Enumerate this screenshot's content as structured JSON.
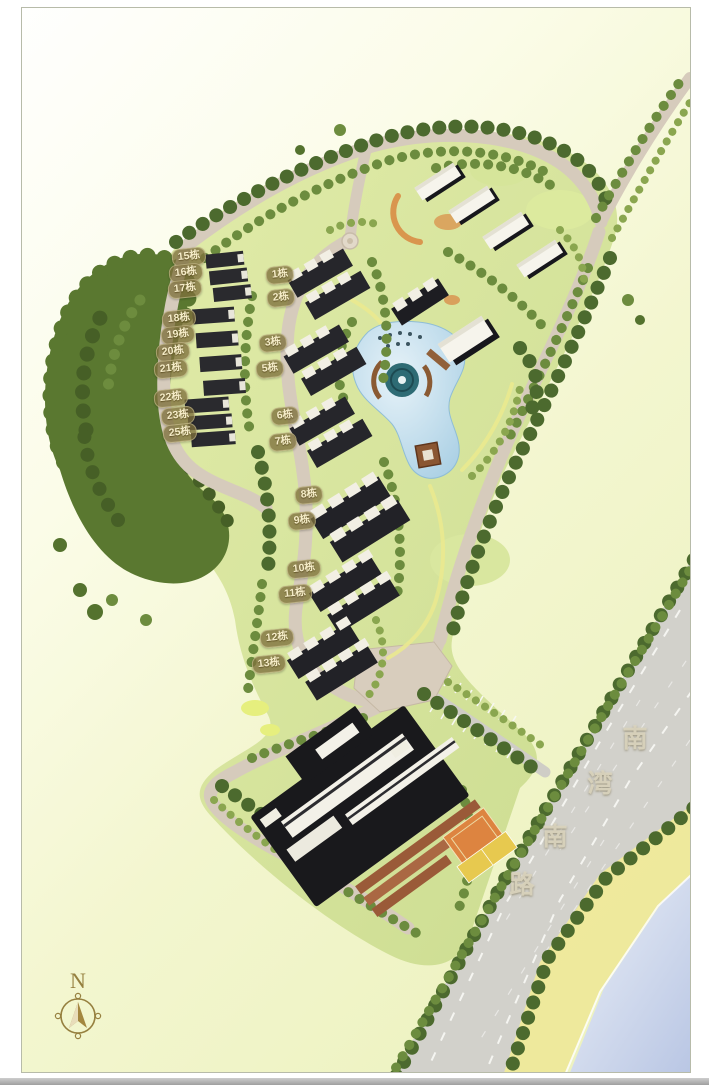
{
  "plan": {
    "title_hint": "residential master plan",
    "building_labels": [
      "15栋",
      "16栋",
      "17栋",
      "18栋",
      "19栋",
      "20栋",
      "21栋",
      "22栋",
      "23栋",
      "25栋",
      "1栋",
      "2栋",
      "3栋",
      "5栋",
      "6栋",
      "7栋",
      "8栋",
      "9栋",
      "10栋",
      "11栋",
      "12栋",
      "13栋"
    ]
  },
  "road": {
    "name": "南湾南路",
    "chars": [
      "南",
      "湾",
      "南",
      "路"
    ]
  },
  "compass": {
    "label": "N"
  },
  "watermark": {
    "text": "利嘉閣澳門地產"
  },
  "colors": {
    "lawn": "#d8e4a0",
    "forest": "#57752f",
    "stone_road": "#d6cbbc",
    "asphalt": "#d2d1cb",
    "lake": "#bcd9ea",
    "sea": "#bcc9e6",
    "shore": "#f0ea9c",
    "roof_dark": "#232327",
    "roof_white": "#f5f3ec",
    "court_orange": "#dd8440",
    "court_yellow": "#e7c94f",
    "label_badge": "#7d703c",
    "label_text": "#f5ecc8"
  }
}
